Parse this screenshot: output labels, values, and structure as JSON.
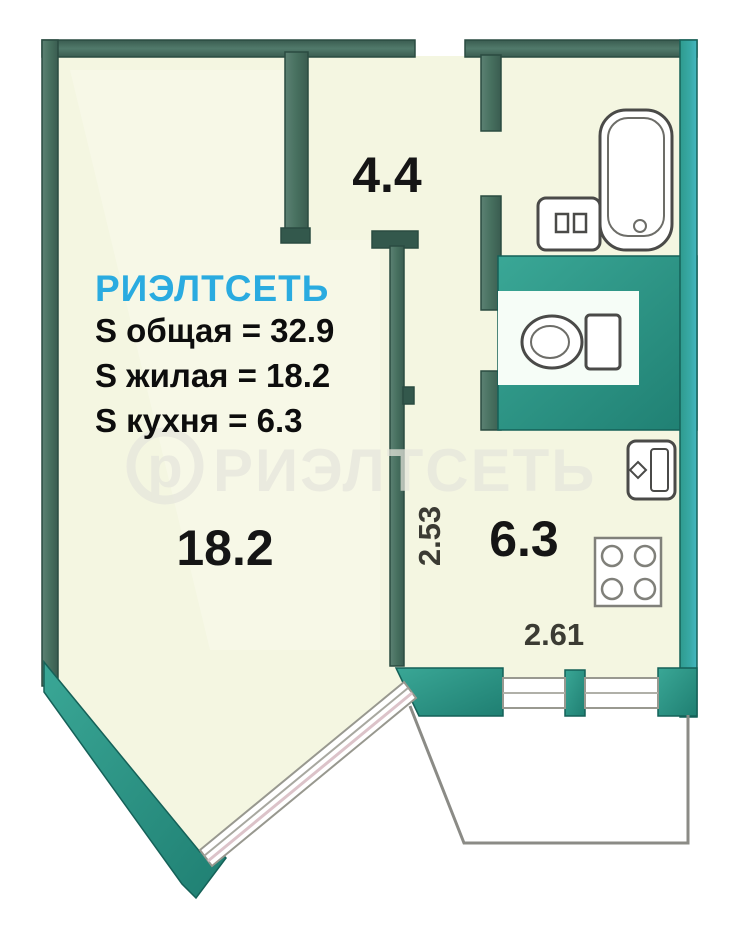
{
  "legend": {
    "brand": "РИЭЛТСЕТЬ",
    "total": "S общая = 32.9",
    "living": "S жилая = 18.2",
    "kitchen": "S кухня = 6.3"
  },
  "rooms": {
    "hall_area": "4.4",
    "living_area": "18.2",
    "kitchen_area": "6.3"
  },
  "dimensions": {
    "kitchen_depth": "2.53",
    "kitchen_width": "2.61"
  },
  "watermark": {
    "logo_letter": "р",
    "text": "РИЭЛТСЕТЬ"
  },
  "colors": {
    "background": "#ffffff",
    "floor": "#f4f6e1",
    "wall_dark": "#4a7265",
    "wall_teal": "#2e9a8c",
    "accent_blue": "#2aabe0",
    "balcony_line": "#8b8b86",
    "fixture_stroke": "#4a4a48"
  }
}
